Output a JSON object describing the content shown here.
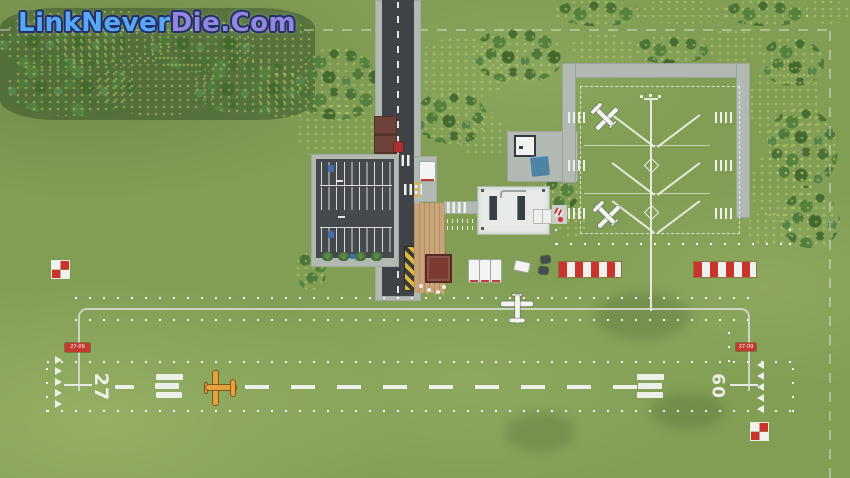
{
  "watermark": {
    "full_text": "LinkNeverDie.Com",
    "blue_part": "LinkNever",
    "purple_part": "Die.Com"
  },
  "runway": {
    "left_number": "27",
    "right_number": "09",
    "left_hold_sign": "27-09",
    "right_hold_sign": "27-09"
  },
  "colors": {
    "grass": "#829e55",
    "asphalt": "#3f4347",
    "path_gray": "#b2b8b2",
    "marking_white": "#edefe9",
    "marker_red": "#c9342c",
    "hazard_yellow": "#e0b63c",
    "plane_yellow": "#e5a23c",
    "pool_blue": "#4d84a6",
    "deck_tan": "#c8a478",
    "watermark_blue": "#5aa8f5",
    "watermark_purple": "#9486dd"
  },
  "objects": {
    "parked_small_planes": 2,
    "taxiing_planes": 1,
    "planes_on_runway": 1,
    "white_vans": 3,
    "cars": 3,
    "buses": 1
  }
}
